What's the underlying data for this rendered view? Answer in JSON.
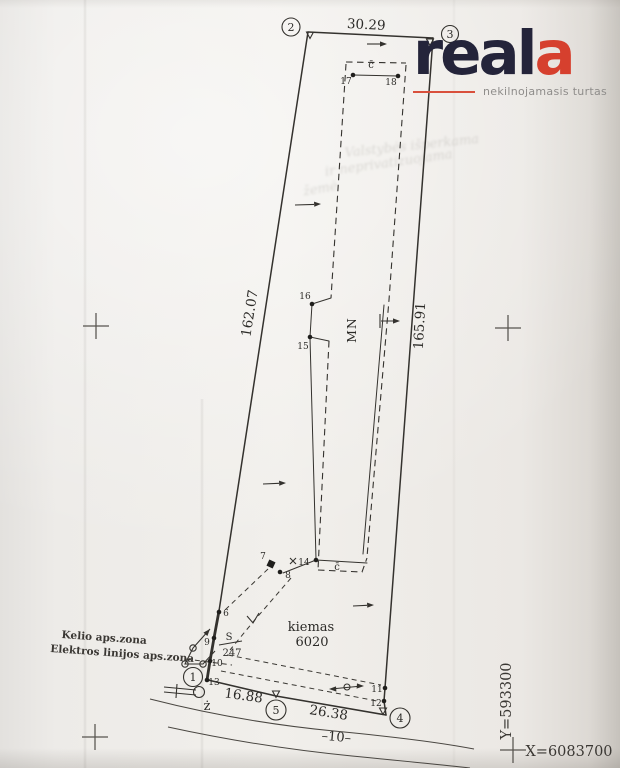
{
  "palette": {
    "ink": "#2c2b28",
    "paper": "#edebe8",
    "accent_red": "#d6402e",
    "brand_navy": "#24243a"
  },
  "logo": {
    "brand": "real",
    "brand_accent": "a",
    "tagline": "nekilnojamasis turtas"
  },
  "plan": {
    "meas_top": "30.29",
    "meas_left": "162.07",
    "meas_right": "165.91",
    "meas_b1": "16.88",
    "meas_b2": "26.38",
    "v1": "1",
    "v2": "2",
    "v3": "3",
    "v4": "4",
    "v5": "5",
    "p6": "6",
    "p7": "7",
    "p8": "8",
    "p9": "9",
    "p10": "10",
    "p11": "11",
    "p12": "12",
    "p13": "13",
    "p14": "14",
    "p15": "15",
    "p16": "16",
    "p17": "17",
    "p18": "18",
    "north": "MN",
    "kiemas": "kiemas",
    "kiemas_no": "6020",
    "zone1": "Kelio aps.zona",
    "zone2": "Elektros linijos aps.zona",
    "frac_top": "S",
    "frac_bottom": "247",
    "c1": "c̄",
    "c2": "c̄",
    "zdot": "ż",
    "road": "–10–",
    "coord_y": "Y=593300",
    "coord_x": "X=6083700",
    "faint1": "Valstybės išperkama",
    "faint2": "ir neprivatizuojama",
    "faint3": "žemė"
  }
}
